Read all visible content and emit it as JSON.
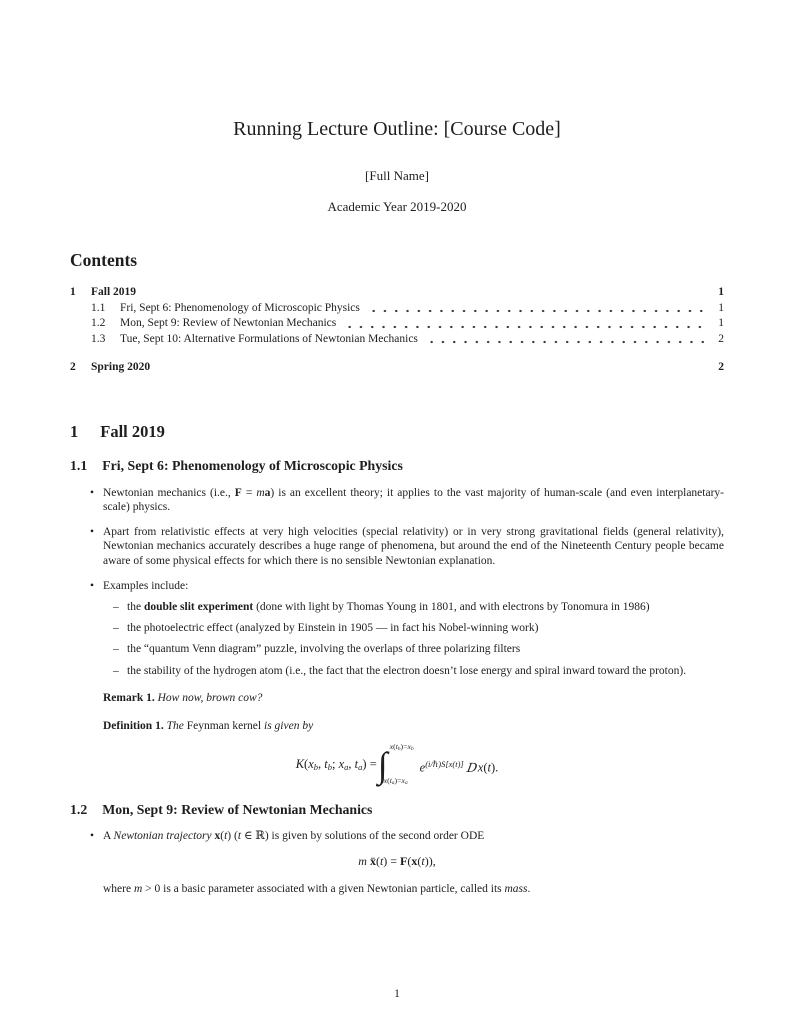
{
  "colors": {
    "text": "#1e1e1e",
    "background": "#ffffff"
  },
  "markers": {
    "bullet": "•",
    "dash": "–",
    "integral": "∫"
  },
  "header": {
    "title": "Running Lecture Outline: [Course Code]",
    "author": "[Full Name]",
    "date": "Academic Year 2019-2020"
  },
  "toc": {
    "heading": "Contents",
    "items": [
      {
        "num": "1",
        "title": "Fall 2019",
        "page": "1"
      },
      {
        "num": "1.1",
        "title": "Fri, Sept 6: Phenomenology of Microscopic Physics",
        "page": "1"
      },
      {
        "num": "1.2",
        "title": "Mon, Sept 9: Review of Newtonian Mechanics",
        "page": "1"
      },
      {
        "num": "1.3",
        "title": "Tue, Sept 10: Alternative Formulations of Newtonian Mechanics",
        "page": "2"
      },
      {
        "num": "2",
        "title": "Spring 2020",
        "page": "2"
      }
    ]
  },
  "sections": {
    "fall": {
      "num": "1",
      "title": "Fall 2019"
    },
    "s11": {
      "num": "1.1",
      "title": "Fri, Sept 6: Phenomenology of Microscopic Physics"
    },
    "s12": {
      "num": "1.2",
      "title": "Mon, Sept 9: Review of Newtonian Mechanics"
    }
  },
  "content": {
    "bullet1": [
      {
        "t": "Newtonian mechanics (i.e., ",
        "s": ""
      },
      {
        "t": "F",
        "s": "b"
      },
      {
        "t": " = ",
        "s": ""
      },
      {
        "t": "m",
        "s": "i"
      },
      {
        "t": "a",
        "s": "b"
      },
      {
        "t": ") is an excellent theory; it applies to the vast majority of human-scale (and even interplanetary-scale) physics.",
        "s": ""
      }
    ],
    "bullet2": [
      {
        "t": "Apart from relativistic effects at very high velocities (special relativity) or in very strong gravitational fields (general relativity), Newtonian mechanics accurately describes a huge range of phenomena, but around the end of the Nineteenth Century people became aware of some physical effects for which there is no sensible Newtonian explanation.",
        "s": ""
      }
    ],
    "bullet3": [
      {
        "t": "Examples include:",
        "s": ""
      }
    ],
    "sub1": [
      {
        "t": "the ",
        "s": ""
      },
      {
        "t": "double slit experiment",
        "s": "b"
      },
      {
        "t": " (done with light by Thomas Young in 1801, and with electrons by Tonomura in 1986)",
        "s": ""
      }
    ],
    "sub2": [
      {
        "t": "the photoelectric effect (analyzed by Einstein in 1905 — in fact his Nobel-winning work)",
        "s": ""
      }
    ],
    "sub3": [
      {
        "t": "the “quantum Venn diagram” puzzle, involving the overlaps of three polarizing filters",
        "s": ""
      }
    ],
    "sub4": [
      {
        "t": "the stability of the hydrogen atom (i.e., the fact that the electron doesn’t lose energy and spiral inward toward the proton).",
        "s": ""
      }
    ],
    "remark": [
      {
        "t": "Remark 1.",
        "s": "b"
      },
      {
        "t": " ",
        "s": ""
      },
      {
        "t": "How now, brown cow?",
        "s": "i"
      }
    ],
    "definition": [
      {
        "t": "Definition 1.",
        "s": "b"
      },
      {
        "t": " ",
        "s": ""
      },
      {
        "t": "The",
        "s": "i"
      },
      {
        "t": " Feynman kernel ",
        "s": ""
      },
      {
        "t": "is given by",
        "s": "i"
      }
    ],
    "kernel_formula": {
      "lhs": [
        {
          "t": "K",
          "s": "i"
        },
        {
          "t": "(",
          "s": ""
        },
        {
          "t": "x",
          "s": "i"
        },
        {
          "t": "b",
          "s": "i sub"
        },
        {
          "t": ", ",
          "s": ""
        },
        {
          "t": "t",
          "s": "i"
        },
        {
          "t": "b",
          "s": "i sub"
        },
        {
          "t": "; ",
          "s": ""
        },
        {
          "t": "x",
          "s": "i"
        },
        {
          "t": "a",
          "s": "i sub"
        },
        {
          "t": ", ",
          "s": ""
        },
        {
          "t": "t",
          "s": "i"
        },
        {
          "t": "a",
          "s": "i sub"
        },
        {
          "t": ") = ",
          "s": ""
        }
      ],
      "int_upper": [
        {
          "t": "x",
          "s": "i"
        },
        {
          "t": "(",
          "s": ""
        },
        {
          "t": "t",
          "s": "i"
        },
        {
          "t": "b",
          "s": "i sub"
        },
        {
          "t": ")=",
          "s": ""
        },
        {
          "t": "x",
          "s": "i"
        },
        {
          "t": "b",
          "s": "i sub"
        }
      ],
      "int_lower": [
        {
          "t": "x",
          "s": "i"
        },
        {
          "t": "(",
          "s": ""
        },
        {
          "t": "t",
          "s": "i"
        },
        {
          "t": "a",
          "s": "i sub"
        },
        {
          "t": ")=",
          "s": ""
        },
        {
          "t": "x",
          "s": "i"
        },
        {
          "t": "a",
          "s": "i sub"
        }
      ],
      "rhs": [
        {
          "t": "e",
          "s": "i"
        },
        {
          "t": "(i/ℏ)S[x(t)]",
          "s": "i sup"
        },
        {
          "t": "D",
          "s": "scr"
        },
        {
          "t": "x",
          "s": "i"
        },
        {
          "t": "(",
          "s": ""
        },
        {
          "t": "t",
          "s": "i"
        },
        {
          "t": ").",
          "s": ""
        }
      ]
    },
    "bullet12_1": [
      {
        "t": "A ",
        "s": ""
      },
      {
        "t": "Newtonian trajectory",
        "s": "i"
      },
      {
        "t": " ",
        "s": ""
      },
      {
        "t": "x",
        "s": "b"
      },
      {
        "t": "(",
        "s": ""
      },
      {
        "t": "t",
        "s": "i"
      },
      {
        "t": ") (",
        "s": ""
      },
      {
        "t": "t",
        "s": "i"
      },
      {
        "t": " ∈ ℝ) is given by solutions of the second order ODE",
        "s": ""
      }
    ],
    "ode_formula": [
      {
        "t": "m",
        "s": "i"
      },
      {
        "t": " ",
        "s": ""
      },
      {
        "t": "ẍ",
        "s": "b"
      },
      {
        "t": "(",
        "s": ""
      },
      {
        "t": "t",
        "s": "i"
      },
      {
        "t": ") = ",
        "s": ""
      },
      {
        "t": "F",
        "s": "b"
      },
      {
        "t": "(",
        "s": ""
      },
      {
        "t": "x",
        "s": "b"
      },
      {
        "t": "(",
        "s": ""
      },
      {
        "t": "t",
        "s": "i"
      },
      {
        "t": ")),",
        "s": ""
      }
    ],
    "where_clause": [
      {
        "t": "where ",
        "s": ""
      },
      {
        "t": "m",
        "s": "i"
      },
      {
        "t": " > 0 is a basic parameter associated with a given Newtonian particle, called its ",
        "s": ""
      },
      {
        "t": "mass",
        "s": "i"
      },
      {
        "t": ".",
        "s": ""
      }
    ]
  },
  "footer": {
    "page_number": "1"
  }
}
